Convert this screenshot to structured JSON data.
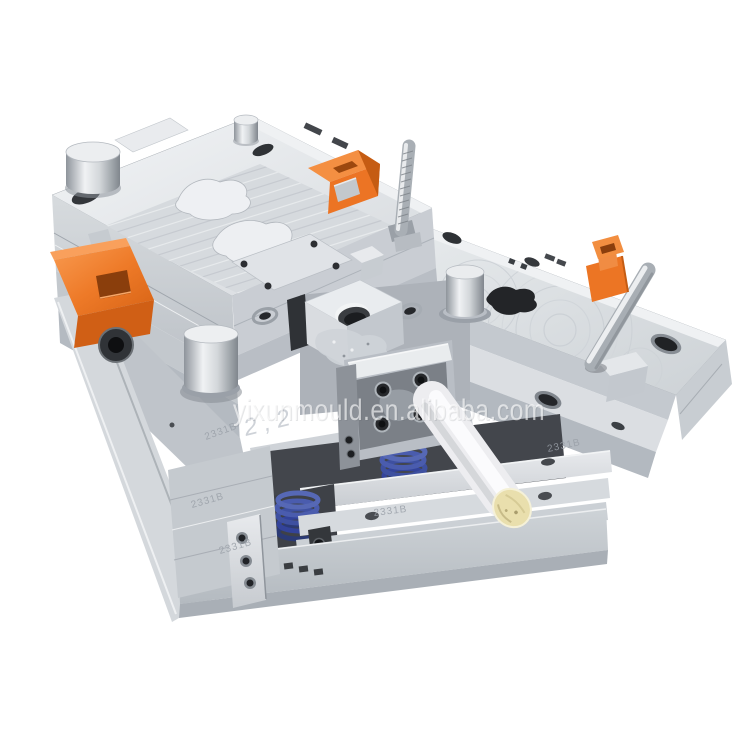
{
  "photo": {
    "subject": "plastic injection mould tool, open halves, isometric studio shot",
    "watermark": "yixunmould.en.alibaba.com",
    "plate_stamp": "2331B",
    "handwritten_mark": "2 , 2"
  },
  "colors": {
    "background": "#ffffff",
    "metal_light": "#eef0f2",
    "metal_mid": "#c6cbd1",
    "metal_dark": "#9aa0a7",
    "hole_dark": "#2b2d31",
    "clamp_orange": "#ee7a28",
    "spring_blue": "#3e50a0",
    "roller_white": "#f3f4f6",
    "roller_cap_cream": "#e9dfad"
  }
}
